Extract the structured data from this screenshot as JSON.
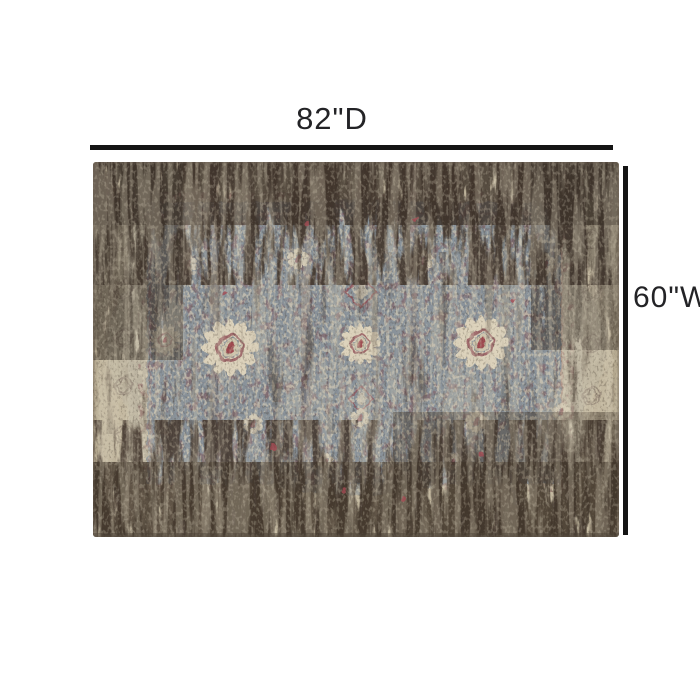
{
  "diagram": {
    "type": "product-dimensions",
    "depth_label": "82\"D",
    "width_label": "60\"W",
    "background_color": "#ffffff",
    "line_color": "#141414",
    "label_color": "#232326",
    "image_description": "Distressed vintage-style area rug: slate blue center field, beige borders, dark charcoal worn pattern, cream floral medallions with maroon and red accents",
    "rug_palette": {
      "beige": "#c2b79e",
      "slate_blue": "#8b96a0",
      "charcoal": "#43382f",
      "cream": "#ddd3bc",
      "maroon": "#8e4e55",
      "red_accent": "#a34b52"
    }
  }
}
